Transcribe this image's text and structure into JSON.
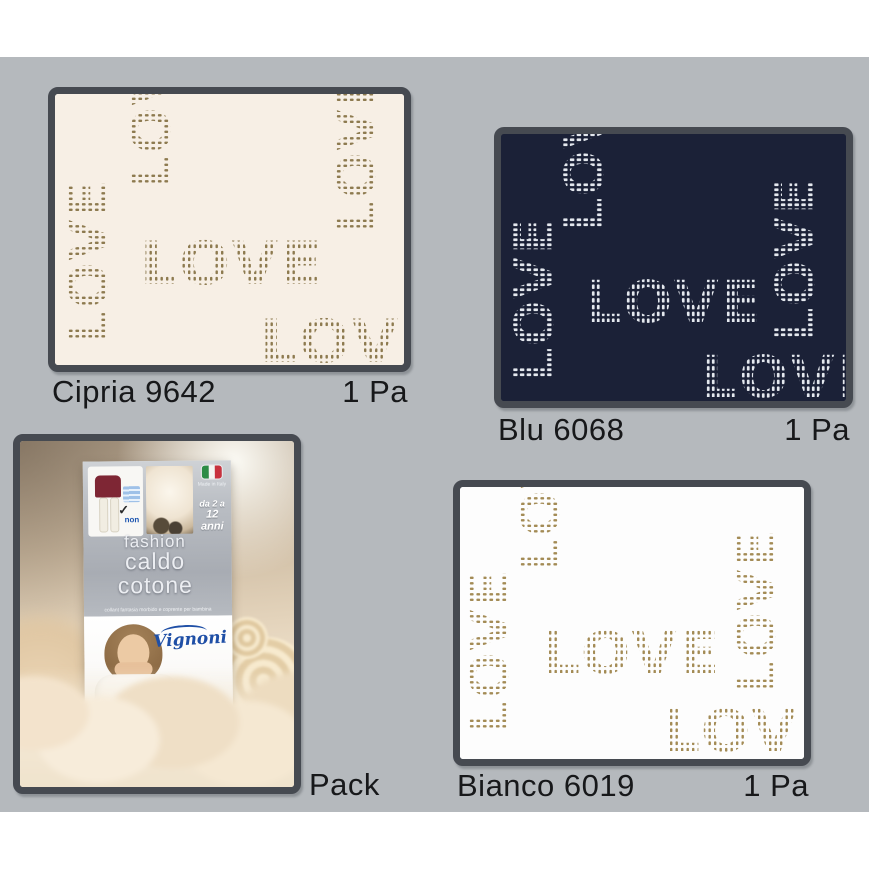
{
  "page": {
    "background_color": "#b5b9bd",
    "margin_color": "#ffffff",
    "panel_border_color": "#464a51",
    "label_text_color": "#17181a"
  },
  "swatches": [
    {
      "name": "Cipria 9642",
      "qty": "1 Pa",
      "pattern_word": "LOVE",
      "fill_color": "#f7efe5",
      "pattern_color": "#8d7a4f"
    },
    {
      "name": "Blu 6068",
      "qty": "1 Pa",
      "pattern_word": "LOVE",
      "fill_color": "#1b2137",
      "pattern_color": "#e4e8ee"
    },
    {
      "name": "Bianco 6019",
      "qty": "1 Pa",
      "pattern_word": "LOVE",
      "fill_color": "#fdfdfd",
      "pattern_color": "#a38b55"
    }
  ],
  "pack": {
    "label": "Pack",
    "package": {
      "title_line1": "fashion",
      "title_line2": "caldo",
      "title_line3": "cotone",
      "tagline": "collant fantasia morbido e coprente per bambina",
      "brand": "Vignoni",
      "made_in": "Made in Italy",
      "age_line1": "da 2 a",
      "age_line2": "12 anni",
      "non_label": "non",
      "check_mark": "✓"
    }
  }
}
